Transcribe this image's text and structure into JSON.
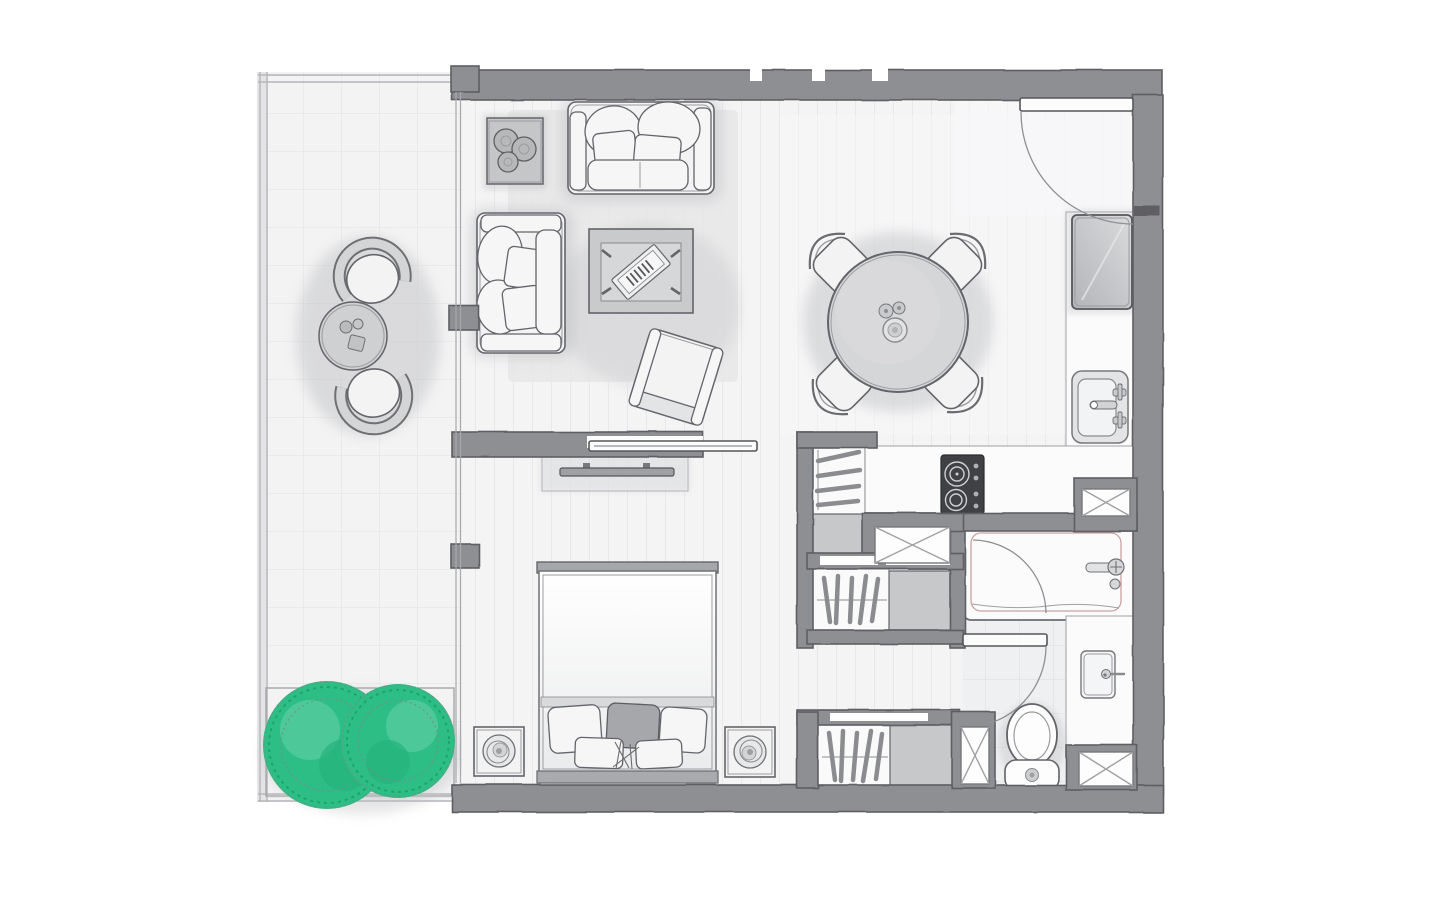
{
  "document": {
    "type": "apartment-floor-plan",
    "style": "hand-drawn architectural sketch, top-down view, no text labels",
    "canvas": {
      "width": 1440,
      "height": 900,
      "background": "#ffffff"
    }
  },
  "colors": {
    "wall": "#8e8f93",
    "wall_edge": "#5e5f63",
    "outline": "#64656a",
    "outline_light": "#9b9c9f",
    "floor": "#f4f4f5",
    "plank": "#e8e8ea",
    "balcony_floor": "#f3f3f4",
    "balcony_tile": "#e2e2e4",
    "bath_floor": "#eff0f2",
    "bath_tile": "#dcdde0",
    "counter": "#fbfbfc",
    "shelf": "#c7c8ca",
    "rug": "#e6e6e8",
    "fill_white": "#f3f3f4",
    "fill_mid": "#cfd0d2",
    "fill_dark": "#a6a7aa",
    "cooktop": "#404145",
    "green": "#2dbe85",
    "green_light": "#55cc9e",
    "green_dark": "#1ea36c",
    "pink": "#caa39e",
    "shadow": "#bcbdc0",
    "glass": "#a7a8ab"
  },
  "rooms": [
    {
      "id": "balcony",
      "name": "balcony-terrace",
      "features": [
        "tiled floor grid",
        "planter with two green bushes",
        "round bistro table with cups",
        "two curved lounge chairs"
      ]
    },
    {
      "id": "living-room",
      "name": "living-room",
      "features": [
        "large two-seat sofa",
        "small loveseat",
        "coffee table with magazines",
        "side table with potted plant",
        "rotated armchair",
        "area rug"
      ]
    },
    {
      "id": "dining-area",
      "name": "dining-area",
      "features": [
        "round dining table",
        "four diagonal chairs",
        "table centerpiece"
      ]
    },
    {
      "id": "kitchen",
      "name": "kitchen",
      "features": [
        "refrigerator",
        "L-shaped counter",
        "sink with mixer taps",
        "two-burner cooktop with knobs",
        "two service shafts"
      ]
    },
    {
      "id": "bedroom",
      "name": "bedroom",
      "features": [
        "double bed with pillows and dark throw",
        "headboard",
        "two nightstands with spiral lamps",
        "wall TV unit",
        "sliding pocket door"
      ]
    },
    {
      "id": "hallway",
      "name": "closet-hallway",
      "features": [
        "tall wardrobe with hangers and shelf",
        "double wardrobe with hangers and shelf",
        "second double wardrobe with hangers and shelf",
        "service shaft"
      ]
    },
    {
      "id": "bathroom",
      "name": "bathroom",
      "features": [
        "bathtub with mixer tap",
        "vanity counter with basin",
        "toilet",
        "inward door swing",
        "service shaft",
        "tiled floor"
      ]
    }
  ],
  "openings": {
    "entry_door": "top-right, leaf along top wall, quarter-circle swing into unit",
    "sliding_door": "pocket door between living room and bedroom, drawn half open",
    "bathroom_door": "leaf with quarter-circle swing near toilet",
    "window_wall": "full-height glazing between balcony and interior with three mullion posts"
  }
}
